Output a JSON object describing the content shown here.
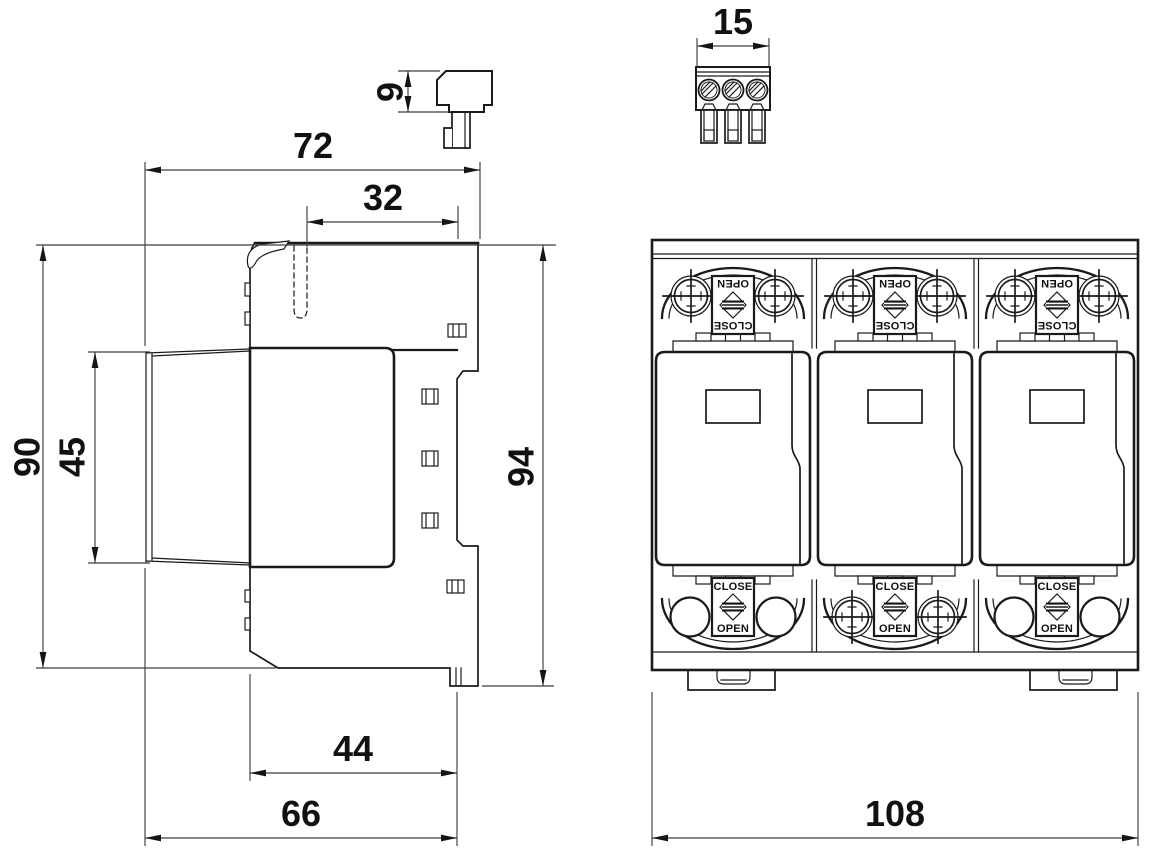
{
  "colors": {
    "line": "#1a1a1a",
    "dim_line": "#3f3f3f",
    "text": "#111111",
    "background": "#ffffff"
  },
  "views": {
    "side": {
      "dims": {
        "total_width": "72",
        "upper_width": "32",
        "body_height": "90",
        "module_height": "45",
        "total_height": "94",
        "lower_width": "44",
        "base_width": "66"
      }
    },
    "connector_side": {
      "dims": {
        "height": "9"
      }
    },
    "connector_front": {
      "dims": {
        "width": "15"
      }
    },
    "front": {
      "dims": {
        "total_width": "108"
      },
      "terminal_labels": {
        "open": "OPEN",
        "close": "CLOSE"
      }
    }
  }
}
